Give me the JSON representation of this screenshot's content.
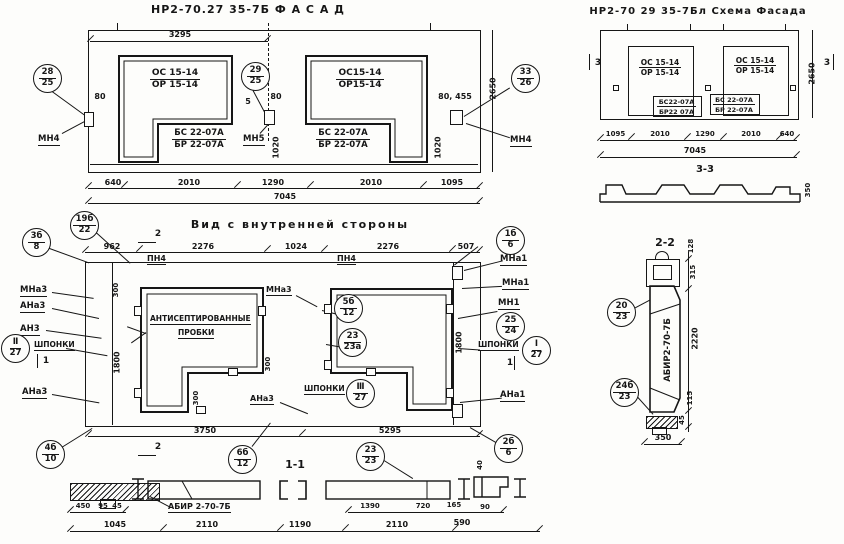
{
  "facade": {
    "title": "НР2-70.27 35-7Б      Ф А С А Д",
    "d3295": "3295",
    "win_left": {
      "top": "ОС 15-14",
      "bot": "ОР 15-14"
    },
    "win_right": {
      "top": "ОС15-14",
      "bot": "ОР15-14"
    },
    "sub_left": {
      "top": "БС 22-07А",
      "bot": "БР 22-07А"
    },
    "sub_right": {
      "top": "БС 22-07А",
      "bot": "БР 22-07А"
    },
    "bal_left": {
      "t": "28",
      "b": "25"
    },
    "bal_center": {
      "t": "29",
      "b": "25"
    },
    "bal_right": {
      "t": "33",
      "b": "26"
    },
    "lbl_mn4_left": "МН4",
    "lbl_mn5": "МН5",
    "lbl_mn4_right": "МН4",
    "d80_left": "80",
    "d5": "5",
    "d80_center": "80",
    "d80_455": "80, 455",
    "d1020_left": "1020",
    "d1020_right": "1020",
    "d2650": "2650",
    "dims_bottom": [
      "640",
      "2010",
      "1290",
      "2010",
      "1095"
    ],
    "d_total": "7045"
  },
  "scheme": {
    "title": "НР2-70 29 35-7Бл   Схема Фасада",
    "win_left": {
      "top": "ОС 15-14",
      "bot": "ОР 15-14"
    },
    "win_right": {
      "top": "ОС 15-14",
      "bot": "ОР 15-14"
    },
    "box_left": {
      "top": "БС22-07А",
      "bot": "БР22 07А"
    },
    "box_right": {
      "top": "БС 22-07А",
      "bot": "БР 22-07А"
    },
    "mark_left": "3",
    "mark_right": "3",
    "d2650": "2650",
    "dims_bottom": [
      "1095",
      "2010",
      "1290",
      "2010",
      "640"
    ],
    "d_total": "7045",
    "section": {
      "title": "3-3",
      "d350": "350"
    }
  },
  "internal": {
    "title": "Вид с внутренней стороны",
    "dims_top": [
      "962",
      "2276",
      "1024",
      "2276",
      "507"
    ],
    "lbl_pn4_left": "ПН4",
    "lbl_pn4_right": "ПН4",
    "mark2_top": "2",
    "mark2_bottom": "2",
    "mark1_left": "1",
    "mark1_right": "1",
    "bal_3b8": {
      "t": "3б",
      "b": "8"
    },
    "bal_19b22": {
      "t": "19б",
      "b": "22"
    },
    "bal_1b6": {
      "t": "1б",
      "b": "6"
    },
    "bal_5b12": {
      "t": "5б",
      "b": "12"
    },
    "bal_2323a": {
      "t": "23",
      "b": "23а"
    },
    "bal_III27": {
      "t": "Ⅲ",
      "b": "27"
    },
    "bal_II27": {
      "t": "Ⅱ",
      "b": "27"
    },
    "bal_I27": {
      "t": "Ⅰ",
      "b": "27"
    },
    "bal_2524": {
      "t": "25",
      "b": "24"
    },
    "bal_4b10": {
      "t": "4б",
      "b": "10"
    },
    "bal_6b12": {
      "t": "6б",
      "b": "12"
    },
    "bal_2323": {
      "t": "23",
      "b": "23"
    },
    "bal_2b6": {
      "t": "2б",
      "b": "6"
    },
    "left_labels": [
      "МНа3",
      "АНа3",
      "АН3",
      "ШПОНКИ",
      "АНа3"
    ],
    "right_labels": [
      "МНа1",
      "МНа1",
      "МН1",
      "ШПОНКИ",
      "АНа1"
    ],
    "lbl_mna3_inner": "МНа3",
    "lbl_ana3_inner": "АНа3",
    "lbl_shponki_inner": "ШПОНКИ",
    "note_line1": "АНТИСЕПТИРОВАННЫЕ",
    "note_line2": "ПРОБКИ",
    "d300_a": "300",
    "d300_b": "300",
    "d300_c": "300",
    "d1800_left": "1800",
    "d1800_right": "1800",
    "d3750": "3750",
    "d5295": "5295"
  },
  "section11": {
    "title": "1-1",
    "label": "АБИР 2-70-7Б",
    "d40": "40",
    "dims_row1": [
      "450",
      "95",
      "45",
      "1390",
      "720",
      "165",
      "90"
    ],
    "dims_row2": [
      "1045",
      "2110",
      "1190",
      "2110",
      "590"
    ]
  },
  "section22": {
    "title": "2-2",
    "label_vertical": "АБИР2-70-7Б",
    "bal_2023": {
      "t": "20",
      "b": "23"
    },
    "bal_24b23": {
      "t": "24б",
      "b": "23"
    },
    "dims": [
      "128",
      "315",
      "2220",
      "115",
      "45"
    ],
    "d350": "350"
  }
}
